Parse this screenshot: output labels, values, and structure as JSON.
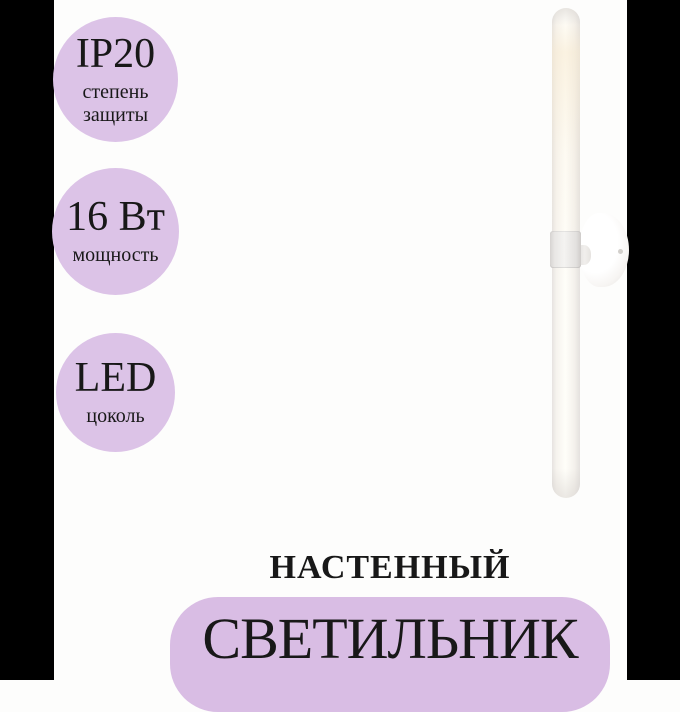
{
  "colors": {
    "badge_bg": "#dcc3e7",
    "banner_bg": "#d9bde4",
    "text": "#181818",
    "pillarbox": "#000000",
    "background": "#fdfdfc"
  },
  "badges": [
    {
      "value": "IP20",
      "caption_lines": [
        "степень",
        "защиты"
      ]
    },
    {
      "value": "16 Вт",
      "caption_lines": [
        "мощность"
      ]
    },
    {
      "value": "LED",
      "caption_lines": [
        "цоколь"
      ]
    }
  ],
  "product": {
    "type_label": "НАСТЕННЫЙ",
    "name_label": "СВЕТИЛЬНИК"
  }
}
